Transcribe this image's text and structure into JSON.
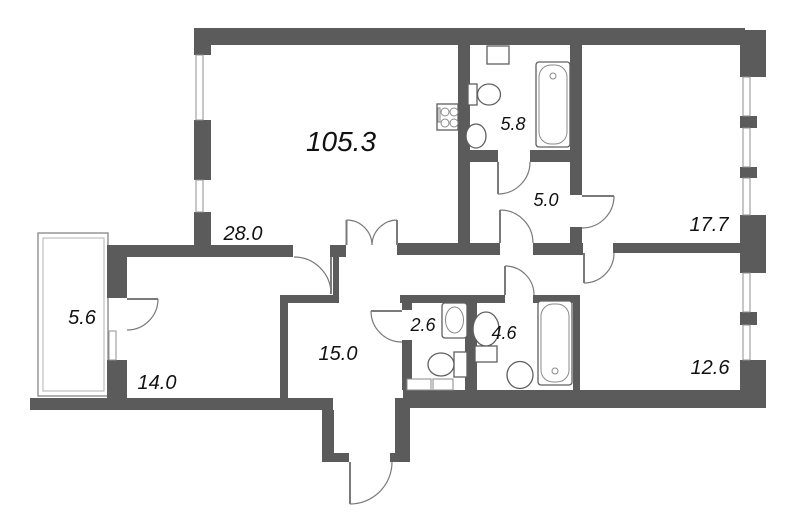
{
  "plan": {
    "type": "apartment-floor-plan",
    "total_area": "105.3",
    "rooms": [
      {
        "name": "living-kitchen",
        "area": "28.0"
      },
      {
        "name": "bathroom-top",
        "area": "5.8"
      },
      {
        "name": "corridor",
        "area": "5.0"
      },
      {
        "name": "bedroom-right",
        "area": "17.7"
      },
      {
        "name": "balcony",
        "area": "5.6"
      },
      {
        "name": "bedroom-left",
        "area": "14.0"
      },
      {
        "name": "hall",
        "area": "15.0"
      },
      {
        "name": "wc",
        "area": "2.6"
      },
      {
        "name": "bathroom-bottom",
        "area": "4.6"
      },
      {
        "name": "bedroom-bottom-right",
        "area": "12.6"
      }
    ],
    "fixtures": [
      "stove-icon",
      "ventilation-shaft",
      "toilet-icon",
      "sink-icon",
      "bathtub-icon"
    ],
    "colors": {
      "wall": "#5b5b5b",
      "line": "#7a7a7a",
      "text": "#111111",
      "background": "#ffffff"
    }
  }
}
